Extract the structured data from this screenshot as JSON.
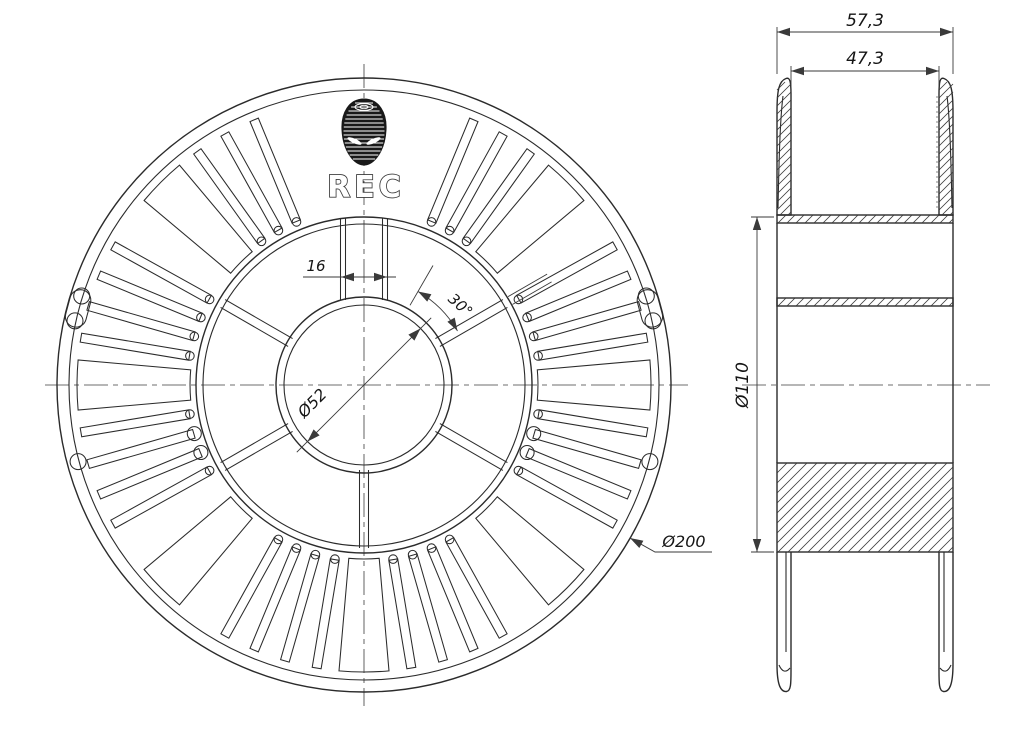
{
  "drawing": {
    "logo": {
      "text": "REC"
    },
    "front_view": {
      "dimensions": {
        "spoke_width": "16",
        "spoke_angle": "30°",
        "hub_diameter": "Ø52",
        "outer_diameter": "Ø200"
      }
    },
    "side_view": {
      "dimensions": {
        "overall_width": "57,3",
        "flange_inner_width": "47,3",
        "barrel_diameter": "Ø110"
      }
    },
    "colors": {
      "line": "#2b2b2b",
      "dim_line": "#3a3a3a",
      "logo_fill": "#191919",
      "background": "#ffffff"
    }
  }
}
